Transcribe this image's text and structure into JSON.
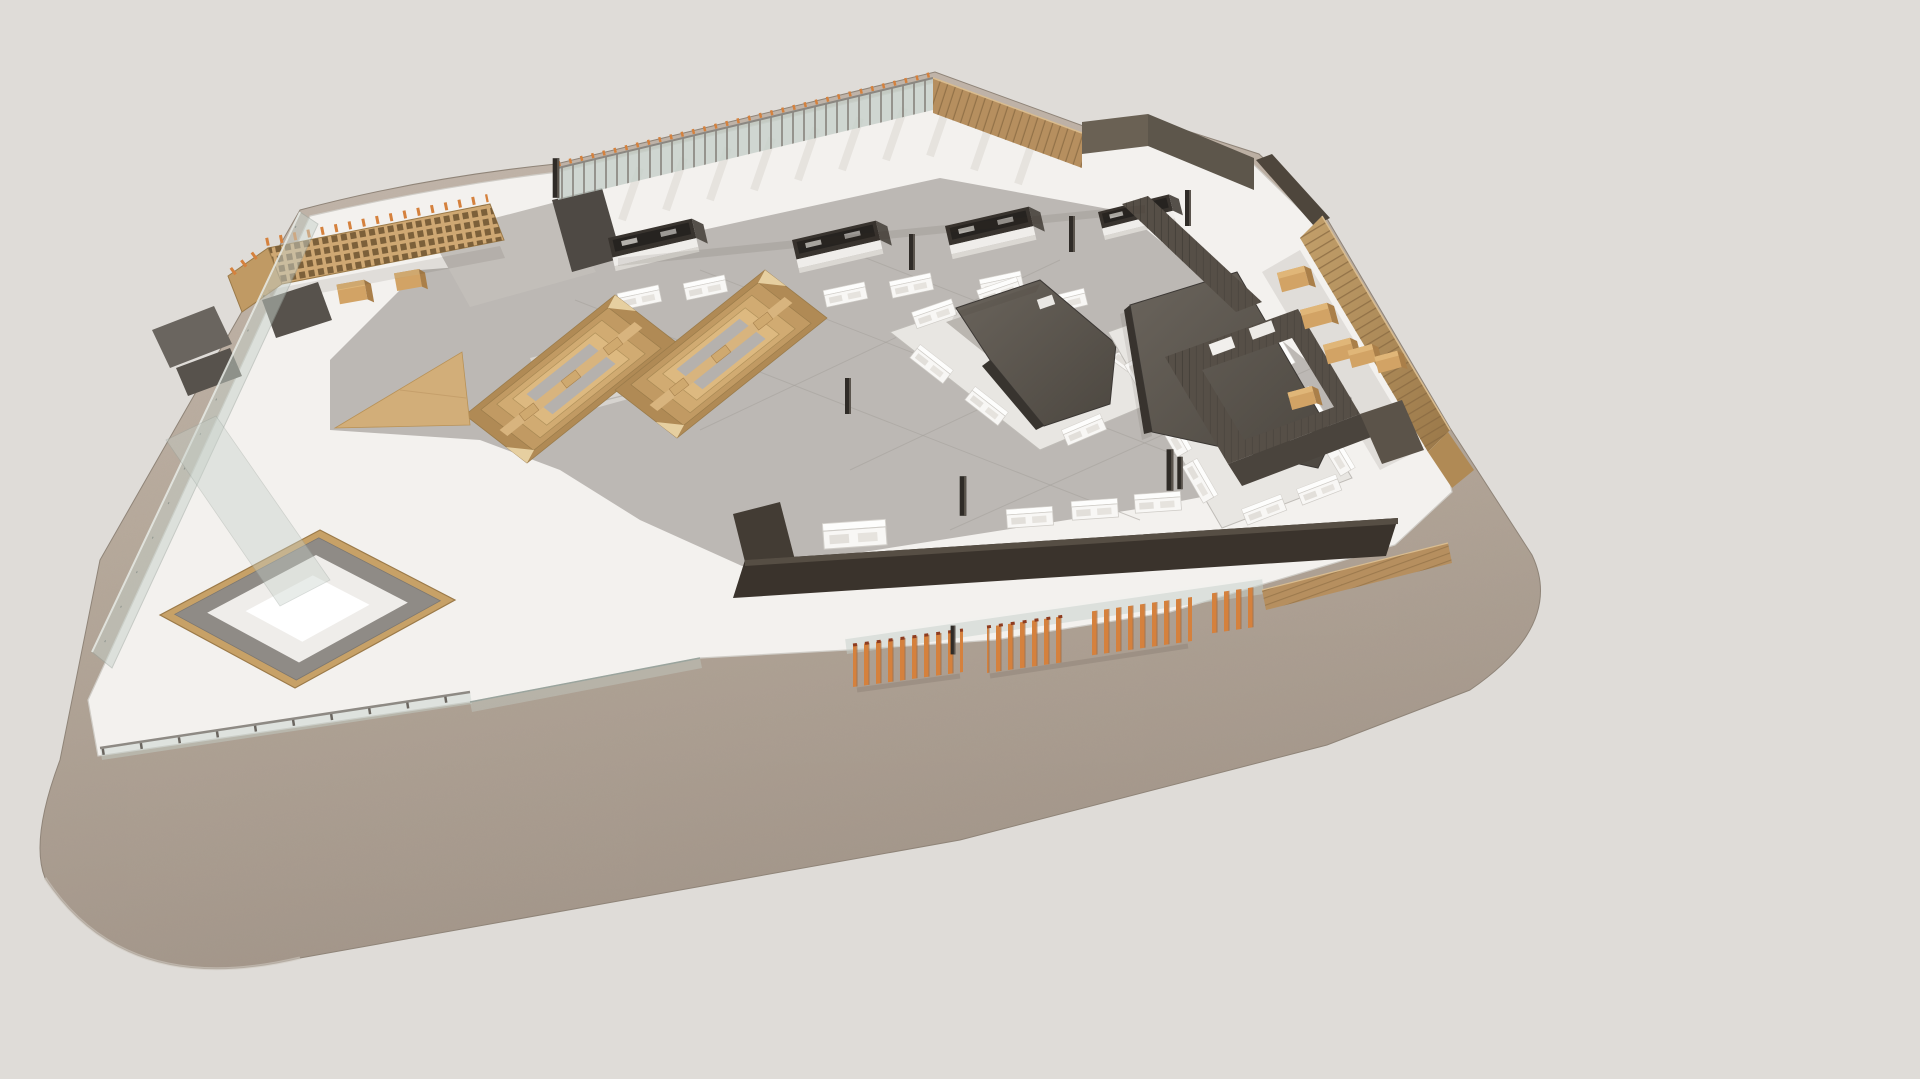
{
  "scene": {
    "type": "3d-architectural-rendering",
    "view": "aerial-isometric",
    "subject": "food-hall-market-floor-model",
    "description": "Aerial axonometric render of a market hall floor plate sitting on a rounded sand-coloured terrace slab"
  },
  "palette": {
    "background": "#dfdcd8",
    "terrace": "#b7aa9c",
    "terrace_light": "#c6bab0",
    "terrace_dark": "#a3968a",
    "terrace_edge": "#8f8478",
    "plate": "#f3f1ee",
    "plate_edge": "#cfccc6",
    "floor": "#bcb8b4",
    "floor_seam": "#a5a19c",
    "wood": "#cfa873",
    "wood_light": "#dfc08c",
    "wood_dark": "#a9834f",
    "wood_fence": "#b68f5f",
    "slat_line": "#8a6a42",
    "orange": "#d5813d",
    "orange_dark": "#8e3c20",
    "charcoal": "#5c564f",
    "charcoal_dark": "#3b3733",
    "wall": "#564f47",
    "stall": "#38332e",
    "white": "#f8f7f5",
    "counter": "#eceae6",
    "glass": "#c6d0c9",
    "glass_edge": "#9aa49d",
    "stone": "#8f8b86",
    "corridor": "#c2beb9"
  },
  "elements": [
    {
      "name": "terrace-base",
      "label": "rounded sand terrace slab",
      "count": 1
    },
    {
      "name": "floor-plate",
      "label": "white market floor plate",
      "count": 1
    },
    {
      "name": "market-floor",
      "label": "grey tiled market floor",
      "count": 1
    },
    {
      "name": "perimeter-fence-top",
      "label": "glass fence with orange-tipped posts",
      "count": 1
    },
    {
      "name": "perimeter-fence-wood-upper",
      "label": "timber slat fence, top right",
      "count": 1
    },
    {
      "name": "perimeter-fence-wood-right",
      "label": "tall timber slat fence, right edge",
      "count": 1
    },
    {
      "name": "low-wood-fence",
      "label": "low timber fence near bottom right",
      "count": 1
    },
    {
      "name": "stall-row",
      "label": "dark food stalls along top wall",
      "count": 4
    },
    {
      "name": "display-counters",
      "label": "white display vitrines",
      "count": 20
    },
    {
      "name": "food-kiosk-1",
      "label": "charcoal roofed kiosk with counter ring",
      "count": 1
    },
    {
      "name": "food-kiosk-2",
      "label": "charcoal wedge-roof kiosk with counter ring",
      "count": 1
    },
    {
      "name": "tiered-seating",
      "label": "stepped timber seating rings",
      "count": 2
    },
    {
      "name": "wine-rack-pergola",
      "label": "timber shelving / wine rack structure",
      "count": 1
    },
    {
      "name": "timber-ramp",
      "label": "triangular timber ramp",
      "count": 1
    },
    {
      "name": "service-counter-band",
      "label": "long dark service counter band",
      "count": 1
    },
    {
      "name": "back-of-house-rooms",
      "label": "dark slatted service rooms",
      "count": 1
    },
    {
      "name": "wood-crates",
      "label": "timber crate counters",
      "count": 8
    },
    {
      "name": "sunken-lounge",
      "label": "timber-framed sunken lounge pit",
      "count": 1
    },
    {
      "name": "glass-balustrade",
      "label": "glass balustrades, left edge",
      "count": 1
    },
    {
      "name": "terrace-railing",
      "label": "terrace edge railing",
      "count": 1
    },
    {
      "name": "orange-fin-screens",
      "label": "orange vertical fin screens",
      "count": 4,
      "fins_per_group": [
        9,
        7,
        9,
        4
      ]
    },
    {
      "name": "columns",
      "label": "slender black columns",
      "count": 9
    }
  ]
}
